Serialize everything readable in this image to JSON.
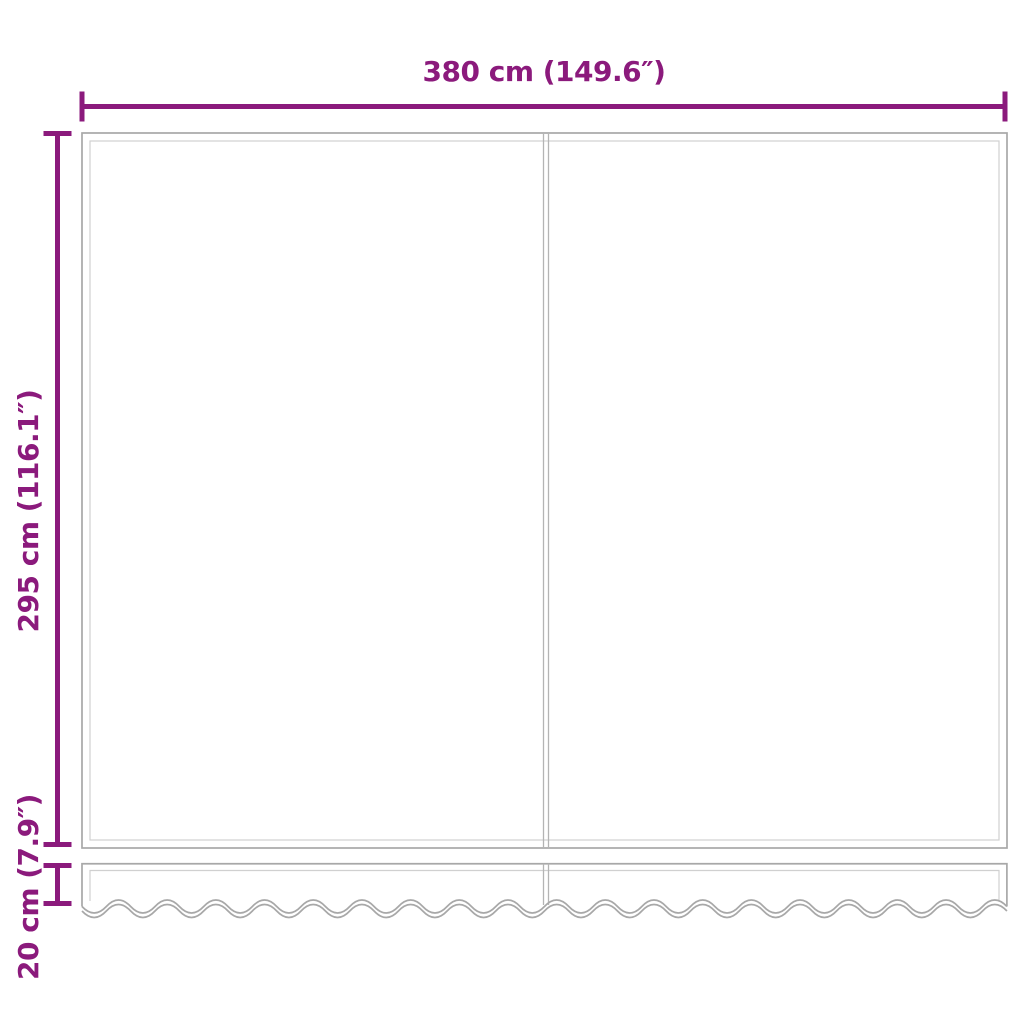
{
  "colors": {
    "accent": "#8b1a7c",
    "outline": "#a8a8a8",
    "inner_line": "#d0d0d0",
    "seam": "#b4b4b4",
    "background": "#ffffff"
  },
  "diagram": {
    "type": "awning-replacement-fabric-dimension-diagram",
    "dimensions": {
      "width": {
        "label": "380 cm (149.6″)"
      },
      "height": {
        "label": "295 cm (116.1″)"
      },
      "valance_height": {
        "label": "20 cm (7.9″)"
      }
    }
  }
}
